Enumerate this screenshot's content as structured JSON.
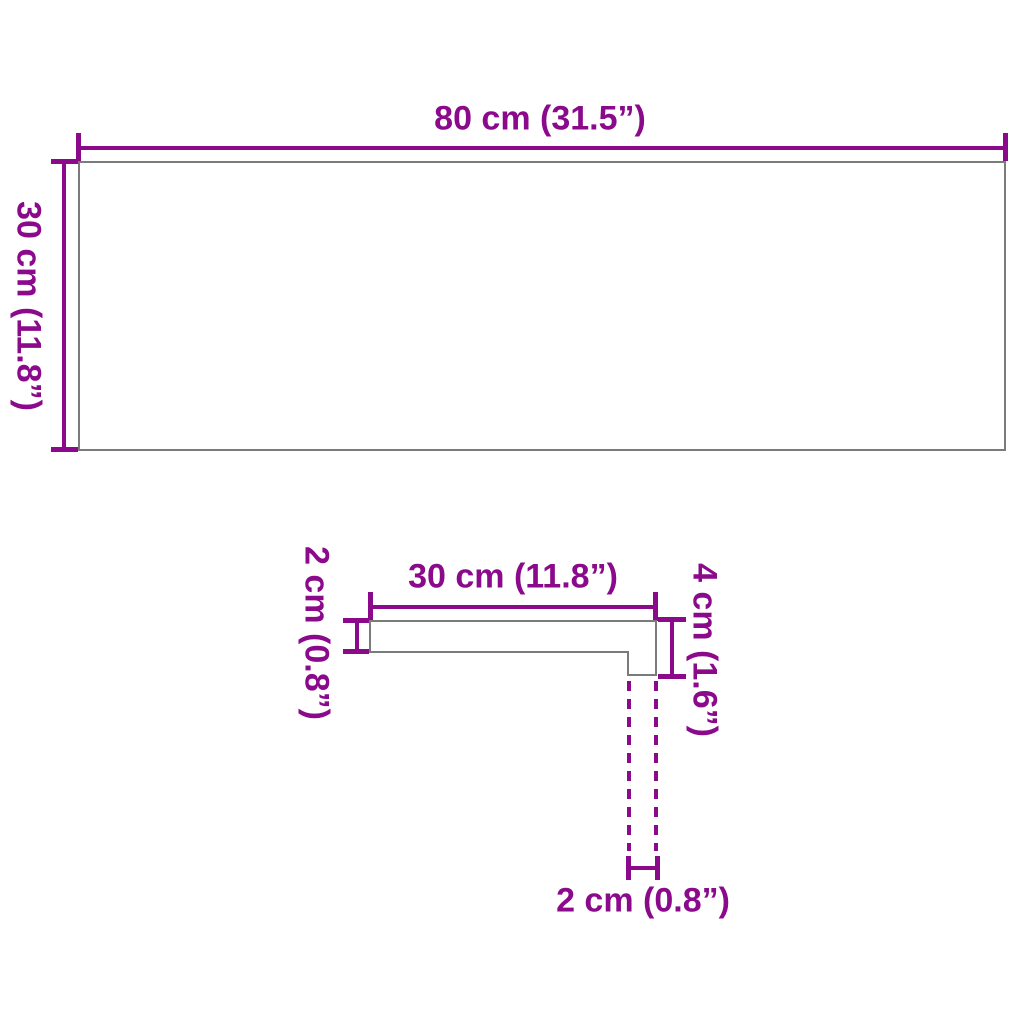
{
  "figure_top": {
    "width_label": "80 cm (31.5”)",
    "height_label": "30 cm (11.8”)"
  },
  "figure_profile": {
    "width_label": "30 cm (11.8”)",
    "thickness_label": "2 cm (0.8”)",
    "nose_height_label": "4 cm (1.6”)",
    "nose_depth_label": "2 cm (0.8”)"
  },
  "colors": {
    "dimension": "#8B0A8C",
    "outline": "#7B7B7B",
    "background": "#FFFFFF"
  }
}
